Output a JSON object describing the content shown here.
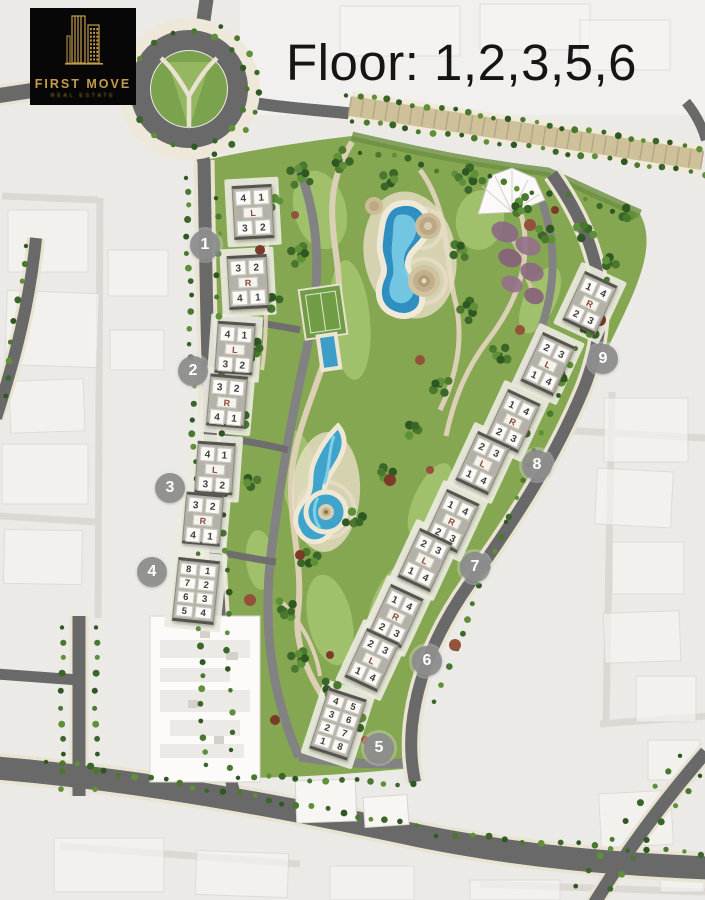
{
  "logo": {
    "brand": "FIRST MOVE",
    "tagline": "REAL ESTATE",
    "accent": "#c59d4a",
    "bg": "#070707"
  },
  "title": {
    "text": "Floor: 1,2,3,5,6"
  },
  "palette": {
    "road": "#696969",
    "site_green": "#86a751",
    "water": "#2e8fc0",
    "lagoon": "#3fa4cb",
    "path": "#dbd0b6",
    "marker_bg": "#8e8e8e",
    "marker_text": "#ffffff",
    "building": "#fbfaf7",
    "core_letter": "#8a4a38"
  },
  "markers": [
    {
      "label": "1",
      "x": 205,
      "y": 245
    },
    {
      "label": "2",
      "x": 193,
      "y": 371
    },
    {
      "label": "3",
      "x": 170,
      "y": 488
    },
    {
      "label": "4",
      "x": 152,
      "y": 572
    },
    {
      "label": "5",
      "x": 379,
      "y": 748
    },
    {
      "label": "6",
      "x": 427,
      "y": 661
    },
    {
      "label": "7",
      "x": 475,
      "y": 567
    },
    {
      "label": "8",
      "x": 537,
      "y": 465
    },
    {
      "label": "9",
      "x": 603,
      "y": 359
    }
  ],
  "buildings": [
    {
      "id": "b1a",
      "cx": 253,
      "cy": 212,
      "w": 40,
      "h": 54,
      "rot": -3,
      "rows": [
        [
          "4",
          "1"
        ],
        [
          "L"
        ],
        [
          "3",
          "2"
        ]
      ]
    },
    {
      "id": "b1b",
      "cx": 248,
      "cy": 282,
      "w": 40,
      "h": 54,
      "rot": -3,
      "rows": [
        [
          "3",
          "2"
        ],
        [
          "R"
        ],
        [
          "4",
          "1"
        ]
      ]
    },
    {
      "id": "b2a",
      "cx": 235,
      "cy": 348,
      "w": 38,
      "h": 52,
      "rot": 4,
      "rows": [
        [
          "4",
          "1"
        ],
        [
          "L"
        ],
        [
          "3",
          "2"
        ]
      ]
    },
    {
      "id": "b2b",
      "cx": 227,
      "cy": 401,
      "w": 38,
      "h": 52,
      "rot": 5,
      "rows": [
        [
          "3",
          "2"
        ],
        [
          "R"
        ],
        [
          "4",
          "1"
        ]
      ]
    },
    {
      "id": "b3a",
      "cx": 215,
      "cy": 468,
      "w": 38,
      "h": 52,
      "rot": 4,
      "rows": [
        [
          "4",
          "1"
        ],
        [
          "L"
        ],
        [
          "3",
          "2"
        ]
      ]
    },
    {
      "id": "b3b",
      "cx": 203,
      "cy": 519,
      "w": 38,
      "h": 52,
      "rot": 5,
      "rows": [
        [
          "3",
          "2"
        ],
        [
          "R"
        ],
        [
          "4",
          "1"
        ]
      ]
    },
    {
      "id": "b4",
      "cx": 196,
      "cy": 591,
      "w": 42,
      "h": 64,
      "rot": 6,
      "rows": [
        [
          "8",
          "1"
        ],
        [
          "7",
          "2"
        ],
        [
          "6",
          "3"
        ],
        [
          "5",
          "4"
        ]
      ]
    },
    {
      "id": "b5",
      "cx": 338,
      "cy": 724,
      "w": 40,
      "h": 64,
      "rot": 18,
      "rows": [
        [
          "4",
          "5"
        ],
        [
          "3",
          "6"
        ],
        [
          "2",
          "7"
        ],
        [
          "1",
          "8"
        ]
      ]
    },
    {
      "id": "d1",
      "cx": 590,
      "cy": 303,
      "w": 36,
      "h": 54,
      "rot": 25,
      "rows": [
        [
          "1",
          "4"
        ],
        [
          "R"
        ],
        [
          "2",
          "3"
        ]
      ]
    },
    {
      "id": "d2",
      "cx": 548,
      "cy": 364,
      "w": 36,
      "h": 54,
      "rot": 25,
      "rows": [
        [
          "2",
          "3"
        ],
        [
          "L"
        ],
        [
          "1",
          "4"
        ]
      ]
    },
    {
      "id": "d3",
      "cx": 513,
      "cy": 421,
      "w": 36,
      "h": 54,
      "rot": 25,
      "rows": [
        [
          "1",
          "4"
        ],
        [
          "R"
        ],
        [
          "2",
          "3"
        ]
      ]
    },
    {
      "id": "d4",
      "cx": 483,
      "cy": 463,
      "w": 36,
      "h": 54,
      "rot": 25,
      "rows": [
        [
          "2",
          "3"
        ],
        [
          "L"
        ],
        [
          "1",
          "4"
        ]
      ]
    },
    {
      "id": "d5",
      "cx": 452,
      "cy": 521,
      "w": 36,
      "h": 54,
      "rot": 25,
      "rows": [
        [
          "1",
          "4"
        ],
        [
          "R"
        ],
        [
          "2",
          "3"
        ]
      ]
    },
    {
      "id": "d6",
      "cx": 425,
      "cy": 560,
      "w": 36,
      "h": 54,
      "rot": 25,
      "rows": [
        [
          "2",
          "3"
        ],
        [
          "L"
        ],
        [
          "1",
          "4"
        ]
      ]
    },
    {
      "id": "d7",
      "cx": 396,
      "cy": 616,
      "w": 36,
      "h": 54,
      "rot": 25,
      "rows": [
        [
          "1",
          "4"
        ],
        [
          "R"
        ],
        [
          "2",
          "3"
        ]
      ]
    },
    {
      "id": "d8",
      "cx": 372,
      "cy": 660,
      "w": 36,
      "h": 54,
      "rot": 25,
      "rows": [
        [
          "2",
          "3"
        ],
        [
          "L"
        ],
        [
          "1",
          "4"
        ]
      ]
    }
  ]
}
